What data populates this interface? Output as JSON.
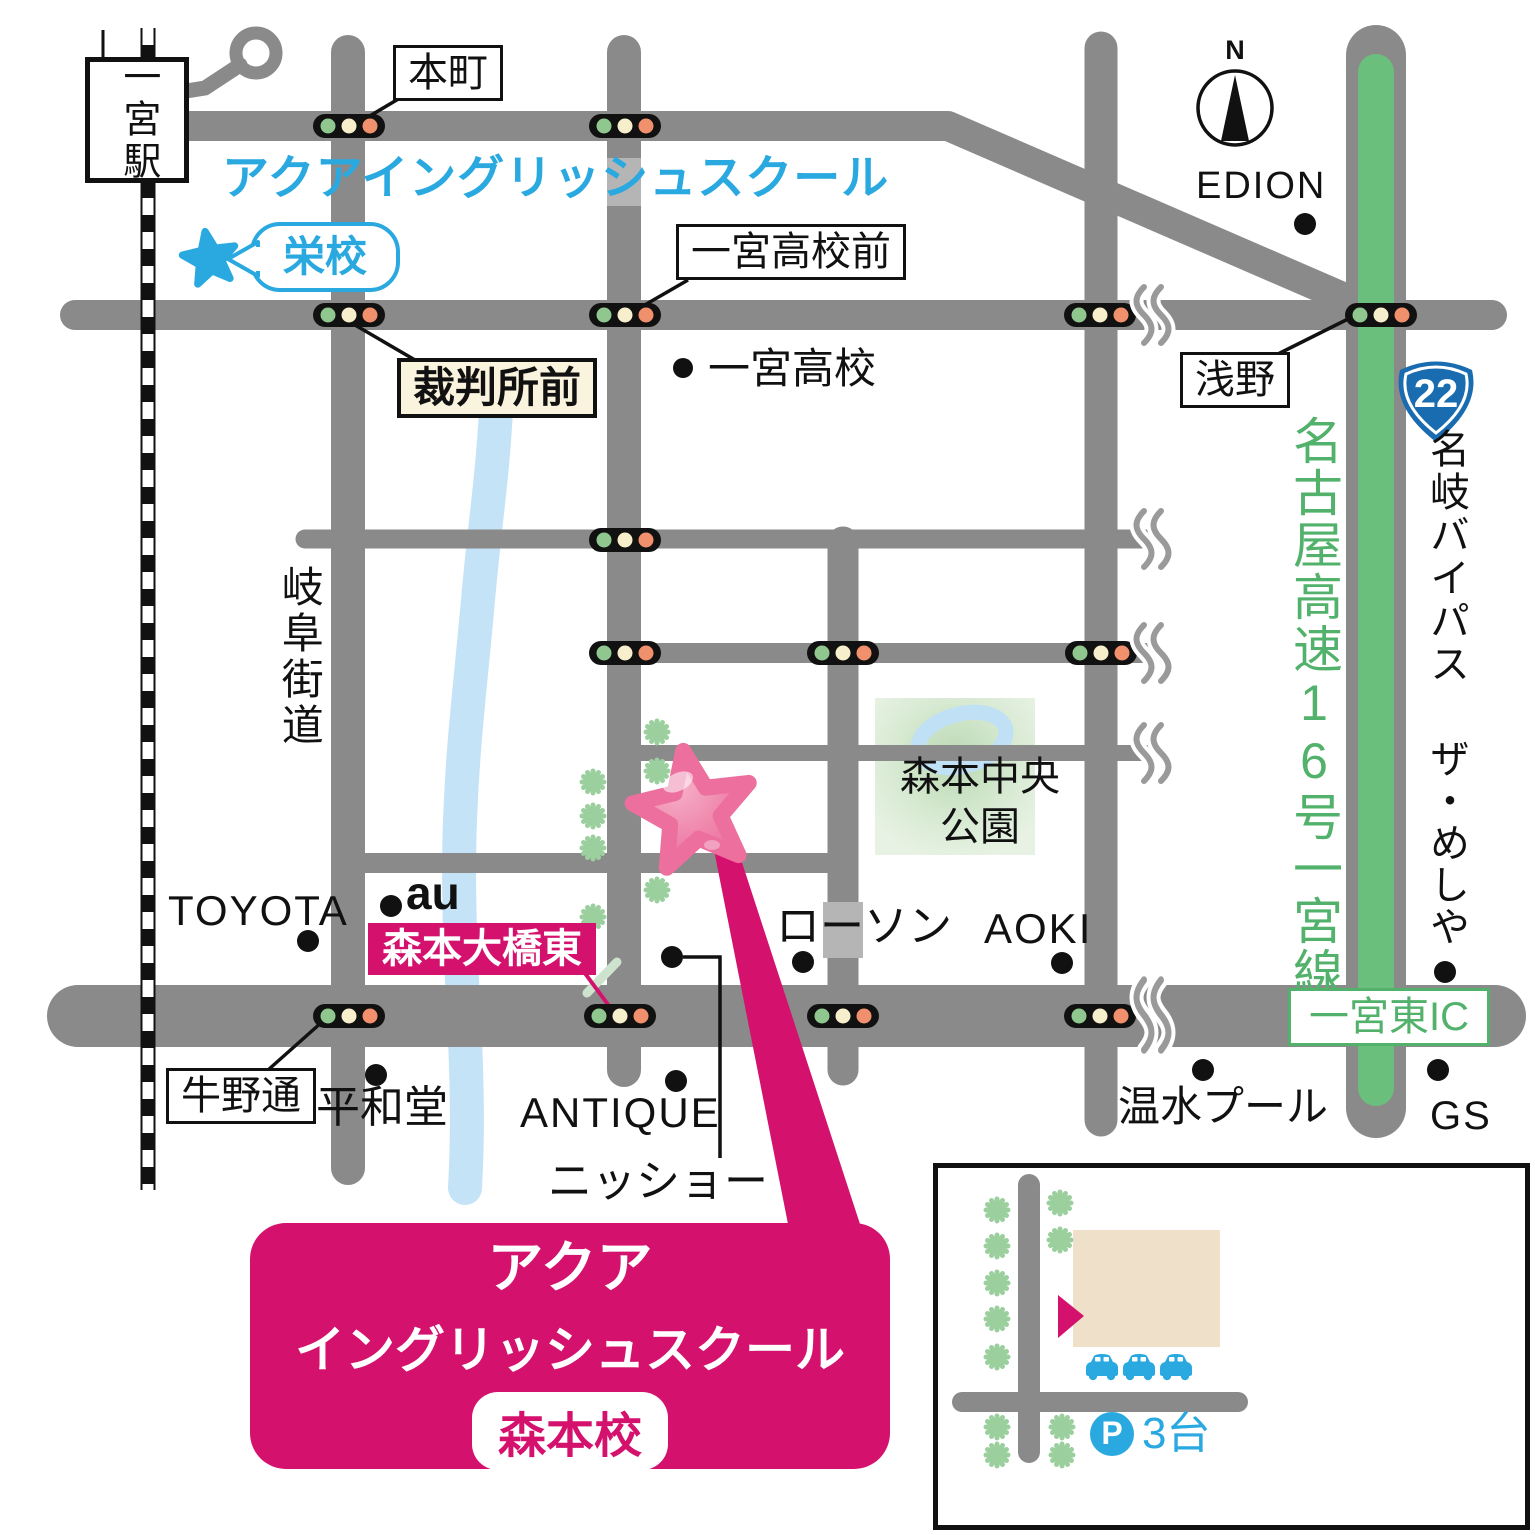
{
  "brand": {
    "school_name": "アクアイングリッシュスクール",
    "sakae_label": "栄校",
    "main_box": {
      "line1": "アクア",
      "line2": "イングリッシュスクール",
      "campus": "森本校"
    }
  },
  "station": {
    "name": "一宮駅"
  },
  "compass": {
    "north": "N"
  },
  "intersections": {
    "honmachi": "本町",
    "koko_mae": "一宮高校前",
    "saibansho_mae": "裁判所前",
    "asano": "浅野",
    "ushinodori": "牛野通",
    "morimoto_ohashi": "森本大橋東"
  },
  "roads": {
    "gifu_kaido": "岐阜街道",
    "nagoya_expwy": "名古屋高速16号一宮線",
    "meigi_bypass": "名岐バイパス",
    "route_number": "22",
    "ic": "一宮東IC"
  },
  "pois": {
    "koko": "一宮高校",
    "edion": "EDION",
    "toyota": "TOYOTA",
    "au": "au",
    "heiwado": "平和堂",
    "antique": "ANTIQUE",
    "nissho": "ニッショー",
    "lawson": "ローソン",
    "aoki": "AOKI",
    "pool": "温水プール",
    "gs": "GS",
    "meshiya": "ザ・めしや",
    "park_line1": "森本中央",
    "park_line2": "公園"
  },
  "inset": {
    "parking_letter": "P",
    "parking_count": "3台"
  },
  "colors": {
    "road": "#8a8a8a",
    "road_light": "#b5b5b5",
    "pink": "#d4126e",
    "star_pink": "#ee7ea6",
    "blue": "#29a9e0",
    "green_road": "#6abf7c",
    "green_text": "#52b26b",
    "tree": "#9ccf9e",
    "cream": "#faf3dd",
    "signal_green": "#8fc78f",
    "signal_yellow": "#f7eecb",
    "signal_red": "#f0906c",
    "river": "#c5e3f7",
    "building": "#efe1c9",
    "badge_blue": "#1a6cb0"
  }
}
